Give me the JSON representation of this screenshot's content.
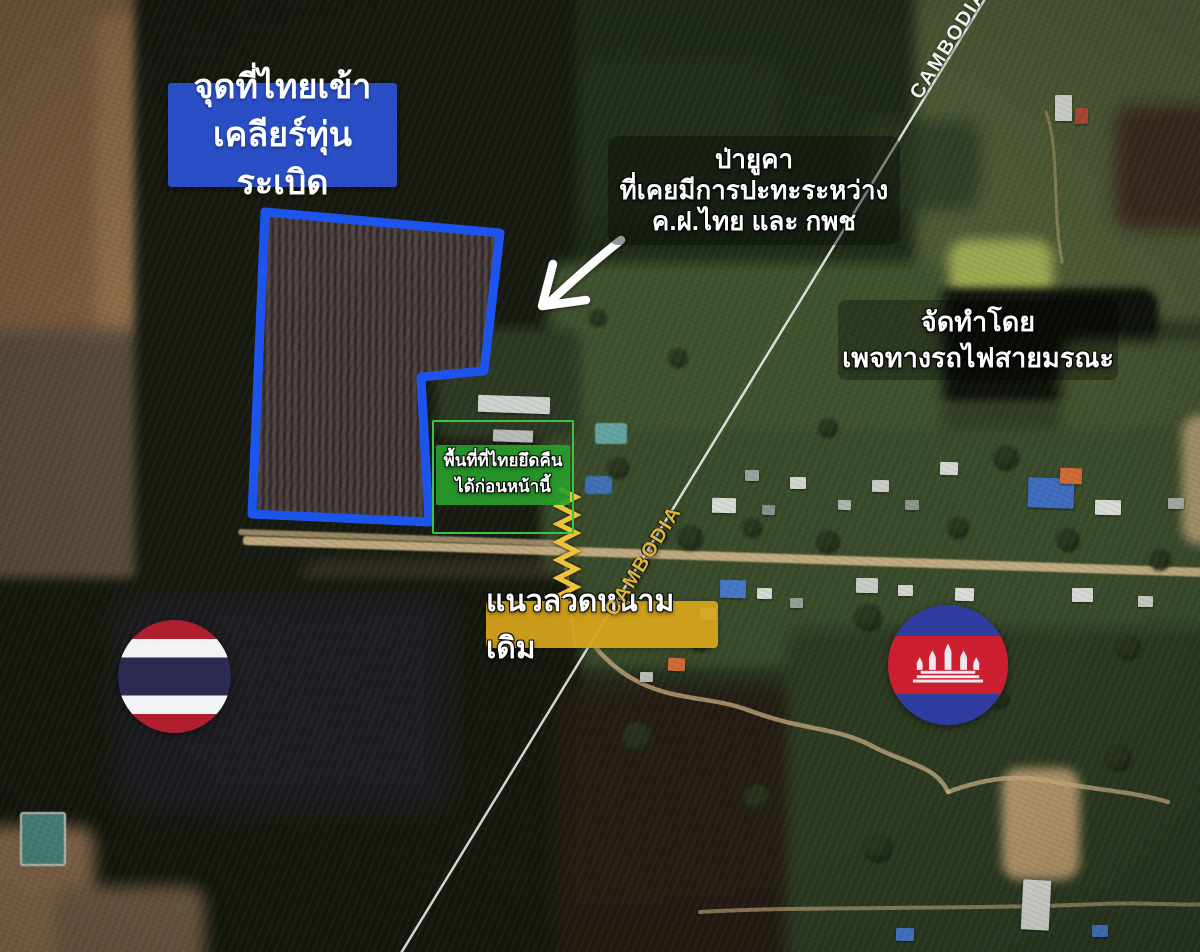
{
  "canvas": {
    "width": 1200,
    "height": 952
  },
  "labels": {
    "mine_clear_point": {
      "lines": [
        "จุดที่ไทยเข้า",
        "เคลียร์ทุ่นระเบิด"
      ],
      "bg_color": "#2a4ec6",
      "text_color": "#ffffff"
    },
    "clash_site": {
      "lines": [
        "ป่ายูคา",
        "ที่เคยมีการปะทะระหว่าง",
        "ค.ฝ.ไทย และ กพช"
      ],
      "text_color": "#ffffff"
    },
    "credit": {
      "lines": [
        "จัดทำโดย",
        "เพจทางรถไฟสายมรณะ"
      ],
      "text_color": "#ffffff"
    },
    "reclaimed_area": {
      "lines": [
        "พื้นที่ที่ไทยยึดคืน",
        "ได้ก่อนหน้านี้"
      ],
      "bg_color": "#28a12b",
      "outline_color": "#3cc43c",
      "text_color": "#ffffff"
    },
    "old_barbed_wire": {
      "text": "แนวลวดหนามเดิม",
      "bg_color": "#d8a61c",
      "text_color": "#ffffff"
    },
    "border_top": "CAMBODIA",
    "border_mid": "CAMBODIA",
    "border_mid_color": "#ddb43e"
  },
  "annotations": {
    "mine_area_outline_color": "#1d54ec",
    "barbed_wire_color": "#eec23a",
    "arrow_color": "#ffffff",
    "border_line_color": "#f5f5f5",
    "dirt_path_color": "#c9ae7f"
  },
  "flags": {
    "thailand": {
      "red": "#b01f2e",
      "white": "#f2f3f5",
      "blue": "#2b2a52"
    },
    "cambodia": {
      "blue": "#2f3da0",
      "red": "#cc2030",
      "white": "#eceaf0"
    }
  },
  "map_features": {
    "patches": [
      {
        "x": -20,
        "y": -20,
        "w": 210,
        "h": 60,
        "c": "#3e4a2a",
        "b": 8
      },
      {
        "x": -20,
        "y": -10,
        "w": 200,
        "h": 365,
        "c": "#7a5b3e",
        "b": 6
      },
      {
        "x": 95,
        "y": 15,
        "w": 75,
        "h": 330,
        "c": "#8d6c48",
        "b": 7
      },
      {
        "x": -20,
        "y": 330,
        "w": 190,
        "h": 300,
        "c": "#57493a",
        "b": 9
      },
      {
        "x": 135,
        "y": -20,
        "w": 495,
        "h": 655,
        "c": "#15190f",
        "b": 5
      },
      {
        "x": 575,
        "y": -20,
        "w": 430,
        "h": 340,
        "c": "#1e2816",
        "b": 6
      },
      {
        "x": 915,
        "y": -20,
        "w": 310,
        "h": 340,
        "c": "#4d5a34",
        "b": 7
      },
      {
        "x": 860,
        "y": 120,
        "w": 120,
        "h": 90,
        "c": "#2a3620",
        "b": 8,
        "o": 0.8
      },
      {
        "x": 1115,
        "y": 105,
        "w": 110,
        "h": 125,
        "c": "#3b2a1e",
        "b": 9
      },
      {
        "x": 948,
        "y": 240,
        "w": 105,
        "h": 62,
        "c": "#aab656",
        "b": 6,
        "o": 0.85
      },
      {
        "x": 823,
        "y": 288,
        "w": 335,
        "h": 112,
        "c": "#0d100a",
        "b": 4
      },
      {
        "x": 548,
        "y": 262,
        "w": 395,
        "h": 305,
        "c": "#3f512d",
        "b": 7
      },
      {
        "x": 1060,
        "y": 340,
        "w": 160,
        "h": 120,
        "c": "#42512c",
        "b": 7
      },
      {
        "x": 543,
        "y": 428,
        "w": 680,
        "h": 240,
        "c": "#394a2a",
        "b": 7
      },
      {
        "x": 436,
        "y": 328,
        "w": 145,
        "h": 112,
        "c": "#2c3822",
        "b": 6
      },
      {
        "x": 582,
        "y": 60,
        "w": 200,
        "h": 160,
        "c": "#242e1c",
        "b": 8,
        "o": 0.7
      },
      {
        "x": 300,
        "y": 560,
        "w": 260,
        "h": 70,
        "c": "#3a3326",
        "b": 7,
        "o": 0.8
      },
      {
        "x": -20,
        "y": 578,
        "w": 600,
        "h": 400,
        "c": "#14170d",
        "b": 5
      },
      {
        "x": 118,
        "y": 598,
        "w": 330,
        "h": 210,
        "c": "#232031",
        "b": 12,
        "o": 0.55
      },
      {
        "x": 556,
        "y": 688,
        "w": 290,
        "h": 290,
        "c": "#231b12",
        "b": 8
      },
      {
        "x": 786,
        "y": 628,
        "w": 440,
        "h": 350,
        "c": "#2a3920",
        "b": 7
      },
      {
        "x": -20,
        "y": 826,
        "w": 115,
        "h": 150,
        "c": "#85674a",
        "b": 8
      },
      {
        "x": 55,
        "y": 886,
        "w": 150,
        "h": 90,
        "c": "#6e5941",
        "b": 8
      },
      {
        "x": 1002,
        "y": 768,
        "w": 78,
        "h": 112,
        "c": "#b2966a",
        "b": 5
      },
      {
        "x": 1182,
        "y": 415,
        "w": 45,
        "h": 130,
        "c": "#bfa77c",
        "b": 5,
        "o": 0.8
      }
    ],
    "roads": [
      {
        "x": 243,
        "y": 536,
        "w": 965,
        "h": 9,
        "rot": 1.9,
        "c": "#c9b083",
        "o": 0.95
      },
      {
        "x": 238,
        "y": 529,
        "w": 330,
        "h": 6,
        "rot": 2.0,
        "c": "#b9a176",
        "o": 0.8
      }
    ],
    "dirt_paths": [
      {
        "d": "M596,648 C646,706 700,692 748,710 C806,732 836,726 876,748 C908,764 936,766 948,792",
        "w": 4.5,
        "o": 0.75
      },
      {
        "d": "M948,792 C986,778 1016,774 1056,782 C1096,790 1136,792 1168,802",
        "w": 4.5,
        "o": 0.75
      },
      {
        "d": "M566,568 C570,600 572,620 575,645",
        "w": 3.5,
        "o": 0.6
      },
      {
        "d": "M700,912 C800,906 950,910 1100,904 C1150,902 1185,906 1205,904",
        "w": 4,
        "o": 0.6
      },
      {
        "d": "M1046,112 C1060,150 1052,210 1062,262",
        "w": 3,
        "o": 0.45
      }
    ],
    "ponds": [
      {
        "x": 20,
        "y": 812,
        "w": 42,
        "h": 50,
        "c": "#49887e",
        "border": "#cfd4cc"
      },
      {
        "x": 595,
        "y": 423,
        "w": 32,
        "h": 21,
        "c": "#64a3a0"
      },
      {
        "x": 585,
        "y": 476,
        "w": 27,
        "h": 18,
        "c": "#3f6fb5"
      }
    ],
    "buildings": [
      {
        "x": 478,
        "y": 396,
        "w": 72,
        "h": 17,
        "c": "#cfd2cf",
        "rot": 2
      },
      {
        "x": 493,
        "y": 430,
        "w": 40,
        "h": 12,
        "c": "#b8bcb8",
        "rot": 2
      },
      {
        "x": 712,
        "y": 498,
        "w": 24,
        "h": 15,
        "c": "#d8dad6",
        "rot": 1
      },
      {
        "x": 745,
        "y": 470,
        "w": 14,
        "h": 11,
        "c": "#9aa0a0",
        "rot": 0
      },
      {
        "x": 762,
        "y": 505,
        "w": 13,
        "h": 10,
        "c": "#8a8f8c",
        "rot": 3
      },
      {
        "x": 790,
        "y": 477,
        "w": 16,
        "h": 12,
        "c": "#d2d5d0",
        "rot": 0
      },
      {
        "x": 838,
        "y": 500,
        "w": 13,
        "h": 10,
        "c": "#b0b4ae",
        "rot": 2
      },
      {
        "x": 872,
        "y": 480,
        "w": 17,
        "h": 12,
        "c": "#caccc8",
        "rot": 1
      },
      {
        "x": 905,
        "y": 500,
        "w": 14,
        "h": 10,
        "c": "#8f9490",
        "rot": 0
      },
      {
        "x": 940,
        "y": 462,
        "w": 18,
        "h": 13,
        "c": "#d5d8d3",
        "rot": 2
      },
      {
        "x": 1028,
        "y": 478,
        "w": 46,
        "h": 30,
        "c": "#3d6cc0",
        "rot": 2
      },
      {
        "x": 1060,
        "y": 468,
        "w": 22,
        "h": 16,
        "c": "#cf6a35",
        "rot": 2
      },
      {
        "x": 1095,
        "y": 500,
        "w": 26,
        "h": 15,
        "c": "#d8dbd6",
        "rot": 1
      },
      {
        "x": 1168,
        "y": 498,
        "w": 16,
        "h": 11,
        "c": "#a8aca8",
        "rot": 0
      },
      {
        "x": 700,
        "y": 608,
        "w": 16,
        "h": 12,
        "c": "#d2d5d0",
        "rot": 0
      },
      {
        "x": 720,
        "y": 580,
        "w": 26,
        "h": 18,
        "c": "#4577c8",
        "rot": 2
      },
      {
        "x": 757,
        "y": 588,
        "w": 15,
        "h": 11,
        "c": "#d5d8d3",
        "rot": 1
      },
      {
        "x": 790,
        "y": 598,
        "w": 13,
        "h": 10,
        "c": "#989c98",
        "rot": 0
      },
      {
        "x": 856,
        "y": 578,
        "w": 22,
        "h": 15,
        "c": "#c8cbc6",
        "rot": 1
      },
      {
        "x": 898,
        "y": 585,
        "w": 15,
        "h": 11,
        "c": "#d2d5d0",
        "rot": 0
      },
      {
        "x": 955,
        "y": 588,
        "w": 19,
        "h": 13,
        "c": "#dadcd8",
        "rot": 2
      },
      {
        "x": 1072,
        "y": 588,
        "w": 21,
        "h": 14,
        "c": "#d5d8d3",
        "rot": 0
      },
      {
        "x": 1138,
        "y": 596,
        "w": 15,
        "h": 11,
        "c": "#caccc8",
        "rot": 1
      },
      {
        "x": 668,
        "y": 658,
        "w": 17,
        "h": 13,
        "c": "#cf6a35",
        "rot": 2
      },
      {
        "x": 640,
        "y": 672,
        "w": 13,
        "h": 10,
        "c": "#b8bcb8",
        "rot": 0
      },
      {
        "x": 1022,
        "y": 880,
        "w": 28,
        "h": 50,
        "c": "#d8dad5",
        "rot": 3
      },
      {
        "x": 1092,
        "y": 925,
        "w": 16,
        "h": 12,
        "c": "#4577c8",
        "rot": 0
      },
      {
        "x": 896,
        "y": 928,
        "w": 18,
        "h": 13,
        "c": "#4577c8",
        "rot": 1
      },
      {
        "x": 1055,
        "y": 95,
        "w": 17,
        "h": 26,
        "c": "#d8dad6",
        "rot": 0
      },
      {
        "x": 1075,
        "y": 108,
        "w": 13,
        "h": 16,
        "c": "#b24a33",
        "rot": 0
      }
    ],
    "trees": [
      {
        "x": 690,
        "y": 538,
        "r": 13
      },
      {
        "x": 752,
        "y": 528,
        "r": 10
      },
      {
        "x": 828,
        "y": 542,
        "r": 12
      },
      {
        "x": 958,
        "y": 528,
        "r": 11
      },
      {
        "x": 1006,
        "y": 458,
        "r": 13
      },
      {
        "x": 868,
        "y": 618,
        "r": 14
      },
      {
        "x": 928,
        "y": 638,
        "r": 12
      },
      {
        "x": 1128,
        "y": 648,
        "r": 13
      },
      {
        "x": 618,
        "y": 468,
        "r": 11
      },
      {
        "x": 638,
        "y": 738,
        "r": 16
      },
      {
        "x": 758,
        "y": 798,
        "r": 14
      },
      {
        "x": 878,
        "y": 848,
        "r": 15
      },
      {
        "x": 998,
        "y": 698,
        "r": 12
      },
      {
        "x": 1118,
        "y": 758,
        "r": 14
      },
      {
        "x": 678,
        "y": 358,
        "r": 10
      },
      {
        "x": 598,
        "y": 318,
        "r": 9
      },
      {
        "x": 828,
        "y": 428,
        "r": 10
      },
      {
        "x": 1068,
        "y": 540,
        "r": 12
      },
      {
        "x": 1160,
        "y": 560,
        "r": 11
      },
      {
        "x": 700,
        "y": 640,
        "r": 12
      }
    ]
  }
}
